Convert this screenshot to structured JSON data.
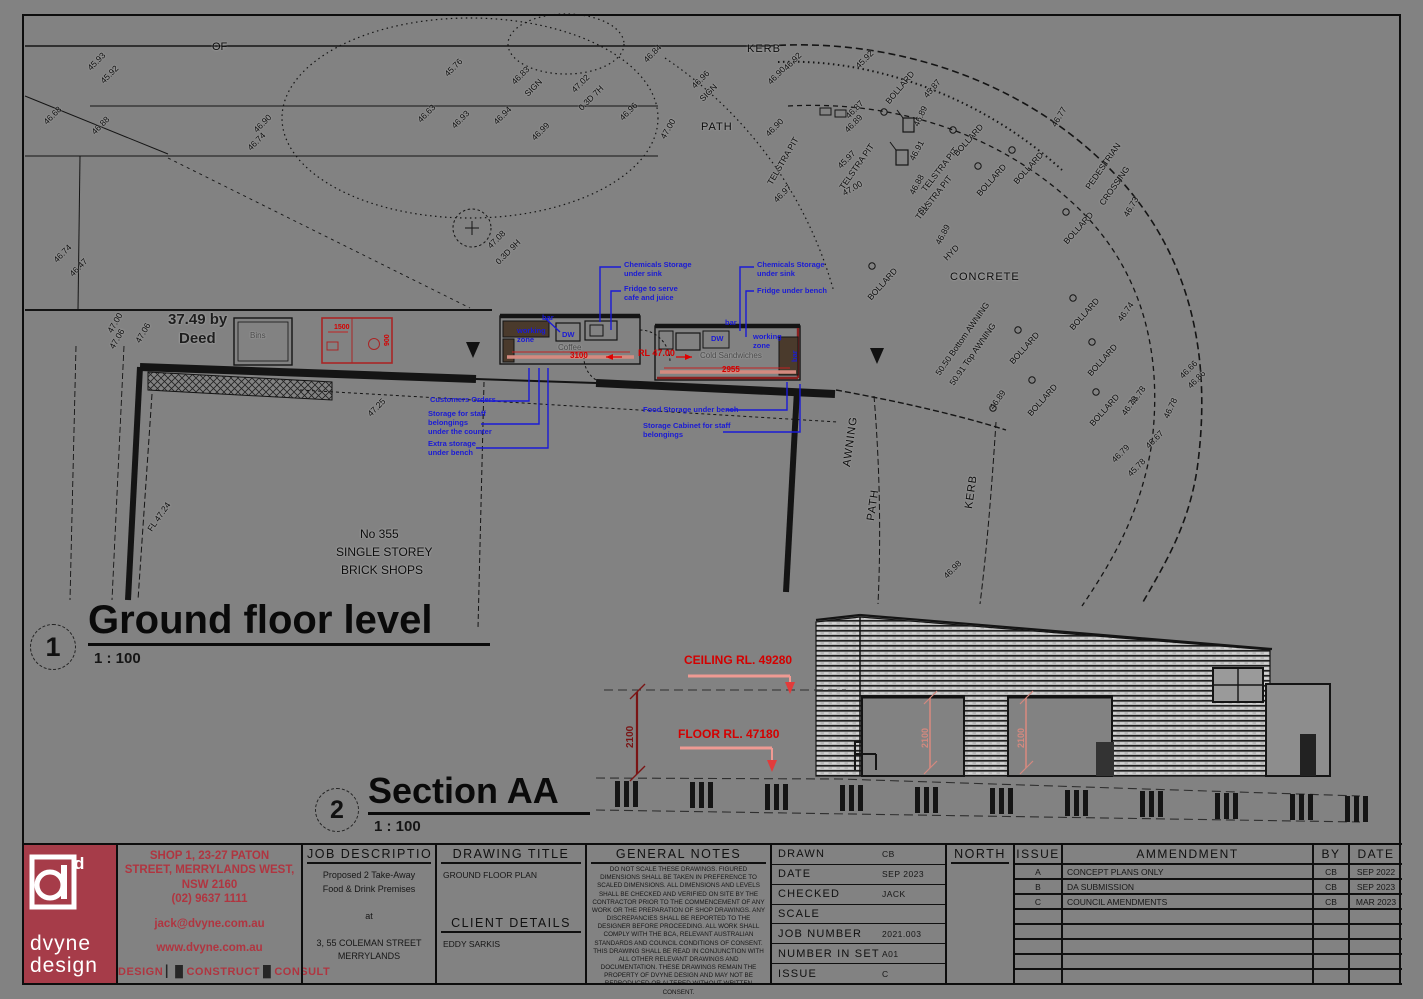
{
  "sheet": {
    "background": "#828282",
    "views": [
      {
        "number": "1",
        "title": "Ground floor level",
        "scale": "1 : 100"
      },
      {
        "number": "2",
        "title": "Section AA",
        "scale": "1 : 100"
      }
    ]
  },
  "drawing": {
    "labels": [
      {
        "t": "OF",
        "x": 212,
        "y": 42,
        "s": 11
      },
      {
        "t": "45.93",
        "x": 86,
        "y": 66,
        "r": -45
      },
      {
        "t": "45.92",
        "x": 99,
        "y": 79,
        "r": -45
      },
      {
        "t": "46.68",
        "x": 42,
        "y": 120,
        "r": -45
      },
      {
        "t": "46.88",
        "x": 90,
        "y": 130,
        "r": -45
      },
      {
        "t": "46.90",
        "x": 252,
        "y": 128,
        "r": -45
      },
      {
        "t": "46.74",
        "x": 246,
        "y": 146,
        "r": -45
      },
      {
        "t": "46.74",
        "x": 52,
        "y": 258,
        "r": -45
      },
      {
        "t": "46.47",
        "x": 68,
        "y": 272,
        "r": -45
      },
      {
        "t": "47.00",
        "x": 106,
        "y": 330,
        "r": -60
      },
      {
        "t": "46.63",
        "x": 416,
        "y": 118,
        "r": -45
      },
      {
        "t": "46.93",
        "x": 450,
        "y": 124,
        "r": -45
      },
      {
        "t": "46.94",
        "x": 492,
        "y": 120,
        "r": -45
      },
      {
        "t": "45.76",
        "x": 443,
        "y": 72,
        "r": -45
      },
      {
        "t": "46.83",
        "x": 510,
        "y": 80,
        "r": -45
      },
      {
        "t": "SIGN",
        "x": 523,
        "y": 92,
        "r": -45
      },
      {
        "t": "47.02",
        "x": 570,
        "y": 88,
        "r": -45
      },
      {
        "t": "0.3D 7H",
        "x": 577,
        "y": 106,
        "r": -45
      },
      {
        "t": "46.84",
        "x": 642,
        "y": 58,
        "r": -45
      },
      {
        "t": "46.96",
        "x": 618,
        "y": 116,
        "r": -45
      },
      {
        "t": "46.99",
        "x": 530,
        "y": 136,
        "r": -45
      },
      {
        "t": "47.00",
        "x": 659,
        "y": 136,
        "r": -60
      },
      {
        "t": "KERB",
        "x": 747,
        "y": 44,
        "c": "place"
      },
      {
        "t": "PATH",
        "x": 701,
        "y": 122,
        "c": "place"
      },
      {
        "t": "46.96",
        "x": 690,
        "y": 84,
        "r": -45
      },
      {
        "t": "SIGN",
        "x": 698,
        "y": 97,
        "r": -45
      },
      {
        "t": "46.92",
        "x": 782,
        "y": 66,
        "r": -45
      },
      {
        "t": "46.90",
        "x": 766,
        "y": 80,
        "r": -45
      },
      {
        "t": "45.92",
        "x": 854,
        "y": 64,
        "r": -45
      },
      {
        "t": "46.90",
        "x": 764,
        "y": 132,
        "r": -45
      },
      {
        "t": "TELSTRA PIT",
        "x": 766,
        "y": 182,
        "r": -60
      },
      {
        "t": "46.97",
        "x": 772,
        "y": 198,
        "r": -45
      },
      {
        "t": "BOLLARD",
        "x": 884,
        "y": 100,
        "r": -50
      },
      {
        "t": "45.87",
        "x": 922,
        "y": 94,
        "r": -50
      },
      {
        "t": "46.87",
        "x": 844,
        "y": 114,
        "r": -45
      },
      {
        "t": "46.89",
        "x": 843,
        "y": 128,
        "r": -45
      },
      {
        "t": "TELSTRA PIT",
        "x": 838,
        "y": 186,
        "r": -55
      },
      {
        "t": "46.89",
        "x": 912,
        "y": 124,
        "r": -65
      },
      {
        "t": "TELSTRA PIT",
        "x": 920,
        "y": 188,
        "r": -52
      },
      {
        "t": "46.91",
        "x": 908,
        "y": 158,
        "r": -62
      },
      {
        "t": "TELSTRA PIT",
        "x": 914,
        "y": 216,
        "r": -52
      },
      {
        "t": "BOLLARD",
        "x": 952,
        "y": 152,
        "r": -48
      },
      {
        "t": "BOLLARD",
        "x": 975,
        "y": 192,
        "r": -48
      },
      {
        "t": "BOLLARD",
        "x": 1012,
        "y": 180,
        "r": -48
      },
      {
        "t": "46.77",
        "x": 1050,
        "y": 124,
        "r": -60
      },
      {
        "t": "PEDESTRIAN",
        "x": 1084,
        "y": 186,
        "r": -55
      },
      {
        "t": "CROSSING",
        "x": 1098,
        "y": 202,
        "r": -55
      },
      {
        "t": "BOLLARD",
        "x": 1062,
        "y": 240,
        "r": -48
      },
      {
        "t": "46.73",
        "x": 1122,
        "y": 214,
        "r": -60
      },
      {
        "t": "46.88",
        "x": 908,
        "y": 192,
        "r": -62
      },
      {
        "t": "SV",
        "x": 916,
        "y": 210,
        "r": -45
      },
      {
        "t": "46.89",
        "x": 934,
        "y": 242,
        "r": -62
      },
      {
        "t": "HYD",
        "x": 942,
        "y": 256,
        "r": -45
      },
      {
        "t": "47.00",
        "x": 841,
        "y": 190,
        "r": -30
      },
      {
        "t": "45.97",
        "x": 836,
        "y": 164,
        "r": -45
      },
      {
        "t": "BOLLARD",
        "x": 866,
        "y": 296,
        "r": -48
      },
      {
        "t": "CONCRETE",
        "x": 950,
        "y": 272,
        "c": "place"
      },
      {
        "t": "50.50 Bottom AWNING",
        "x": 934,
        "y": 372,
        "r": -55
      },
      {
        "t": "50.91 Top AWNING",
        "x": 948,
        "y": 382,
        "r": -55
      },
      {
        "t": "BOLLARD",
        "x": 1008,
        "y": 360,
        "r": -48
      },
      {
        "t": "BOLLARD",
        "x": 1068,
        "y": 326,
        "r": -48
      },
      {
        "t": "BOLLARD",
        "x": 1026,
        "y": 412,
        "r": -48
      },
      {
        "t": "BOLLARD",
        "x": 1086,
        "y": 372,
        "r": -48
      },
      {
        "t": "46.74",
        "x": 1116,
        "y": 318,
        "r": -55
      },
      {
        "t": "BOLLARD",
        "x": 1088,
        "y": 422,
        "r": -48
      },
      {
        "t": "46.78",
        "x": 1128,
        "y": 402,
        "r": -55
      },
      {
        "t": "46.79",
        "x": 1120,
        "y": 412,
        "r": -55
      },
      {
        "t": "46.66",
        "x": 1178,
        "y": 374,
        "r": -45
      },
      {
        "t": "46.86",
        "x": 1186,
        "y": 384,
        "r": -45
      },
      {
        "t": "46.78",
        "x": 1162,
        "y": 416,
        "r": -65
      },
      {
        "t": "46.67",
        "x": 1144,
        "y": 444,
        "r": -45
      },
      {
        "t": "46.79",
        "x": 1110,
        "y": 458,
        "r": -45
      },
      {
        "t": "45.78",
        "x": 1126,
        "y": 472,
        "r": -45
      },
      {
        "t": "46.89",
        "x": 988,
        "y": 406,
        "r": -55
      },
      {
        "t": "KERB",
        "x": 964,
        "y": 508,
        "r": -82,
        "c": "place"
      },
      {
        "t": "AWNING",
        "x": 842,
        "y": 466,
        "r": -82,
        "c": "place"
      },
      {
        "t": "PATH",
        "x": 866,
        "y": 520,
        "r": -82,
        "c": "place"
      },
      {
        "t": "46.98",
        "x": 942,
        "y": 574,
        "r": -45
      },
      {
        "t": "47.06",
        "x": 108,
        "y": 346,
        "r": -60
      },
      {
        "t": "47.06",
        "x": 134,
        "y": 340,
        "r": -60
      },
      {
        "t": "37.49 by",
        "x": 168,
        "y": 312,
        "s": 15,
        "c": "deed"
      },
      {
        "t": "Deed",
        "x": 179,
        "y": 331,
        "s": 15,
        "c": "deed"
      },
      {
        "t": "FL 47.24",
        "x": 146,
        "y": 528,
        "r": -55
      },
      {
        "t": "47.25",
        "x": 366,
        "y": 412,
        "r": -45
      },
      {
        "t": "No 355",
        "x": 360,
        "y": 528,
        "s": 12
      },
      {
        "t": "SINGLE STOREY",
        "x": 336,
        "y": 546,
        "s": 12
      },
      {
        "t": "BRICK SHOPS",
        "x": 341,
        "y": 564,
        "s": 12
      },
      {
        "t": "47.08",
        "x": 486,
        "y": 244,
        "r": -45
      },
      {
        "t": "0.3D 9H",
        "x": 494,
        "y": 260,
        "r": -45
      },
      {
        "t": "Bins",
        "x": 250,
        "y": 332,
        "c": "gray"
      },
      {
        "t": "Coffee",
        "x": 558,
        "y": 344,
        "c": "gray"
      },
      {
        "t": "Cold Sandwiches",
        "x": 700,
        "y": 352,
        "c": "gray"
      },
      {
        "t": "Chemicals Storage\nunder sink",
        "x": 624,
        "y": 260,
        "c": "blue"
      },
      {
        "t": "Fridge to serve\ncafe and juice",
        "x": 624,
        "y": 284,
        "c": "blue"
      },
      {
        "t": "Chemicals Storage\nunder sink",
        "x": 757,
        "y": 260,
        "c": "blue"
      },
      {
        "t": "Fridge under bench",
        "x": 757,
        "y": 286,
        "c": "blue"
      },
      {
        "t": "working\nzone",
        "x": 517,
        "y": 326,
        "c": "blue"
      },
      {
        "t": "bar",
        "x": 542,
        "y": 313,
        "c": "blue"
      },
      {
        "t": "DW",
        "x": 562,
        "y": 330,
        "c": "blue"
      },
      {
        "t": "bar",
        "x": 725,
        "y": 318,
        "c": "blue"
      },
      {
        "t": "DW",
        "x": 711,
        "y": 334,
        "c": "blue"
      },
      {
        "t": "working\nzone",
        "x": 753,
        "y": 332,
        "c": "blue"
      },
      {
        "t": "bar",
        "x": 790,
        "y": 362,
        "r": -90,
        "c": "blue"
      },
      {
        "t": "Customers Orders",
        "x": 430,
        "y": 395,
        "c": "blue"
      },
      {
        "t": "Storage for staff\nbelongings\nunder the counter",
        "x": 428,
        "y": 409,
        "c": "blue"
      },
      {
        "t": "Extra storage\nunder bench",
        "x": 428,
        "y": 439,
        "c": "blue"
      },
      {
        "t": "Food Storage under bench",
        "x": 643,
        "y": 405,
        "c": "blue"
      },
      {
        "t": "Storage Cabinet for staff\nbelongings",
        "x": 643,
        "y": 421,
        "c": "blue"
      },
      {
        "t": "3100",
        "x": 570,
        "y": 352,
        "c": "red"
      },
      {
        "t": "RL 47.00",
        "x": 638,
        "y": 349,
        "c": "red",
        "s": 9
      },
      {
        "t": "2955",
        "x": 722,
        "y": 366,
        "c": "red"
      },
      {
        "t": "1500",
        "x": 334,
        "y": 324,
        "c": "red",
        "s": 7
      },
      {
        "t": "900",
        "x": 384,
        "y": 346,
        "r": -90,
        "c": "red",
        "s": 7
      },
      {
        "t": "CEILING RL. 49280",
        "x": 684,
        "y": 654,
        "c": "red",
        "s": 12
      },
      {
        "t": "FLOOR RL. 47180",
        "x": 678,
        "y": 728,
        "c": "red",
        "s": 12
      },
      {
        "t": "2100",
        "x": 626,
        "y": 748,
        "r": -90,
        "c": "darkred",
        "s": 10
      },
      {
        "t": "2100",
        "x": 921,
        "y": 748,
        "r": -90,
        "c": "pink",
        "s": 9
      },
      {
        "t": "2100",
        "x": 1017,
        "y": 748,
        "r": -90,
        "c": "pink",
        "s": 9
      }
    ]
  },
  "titleblock": {
    "logo": {
      "brand_top": "dvyne",
      "brand_bottom": "design",
      "accent": "#a63c49"
    },
    "contact": {
      "lines": [
        "SHOP 1, 23-27 PATON",
        "STREET, MERRYLANDS WEST,",
        "NSW 2160",
        "(02) 9637 1111",
        "jack@dvyne.com.au",
        "www.dvyne.com.au"
      ],
      "motto": [
        "DESIGN",
        "CONSTRUCT",
        "CONSULT"
      ],
      "text_color": "#b03540"
    },
    "job_description": {
      "header": "JOB DESCRIPTION",
      "body": "Proposed 2 Take-Away\nFood & Drink Premises\n\nat\n\n3, 55 COLEMAN STREET\nMERRYLANDS"
    },
    "drawing_title": {
      "header": "DRAWING TITLE",
      "value": "GROUND FLOOR PLAN"
    },
    "client": {
      "header": "CLIENT DETAILS",
      "value": "EDDY SARKIS"
    },
    "general_notes": {
      "header": "GENERAL NOTES",
      "text": "DO NOT SCALE THESE DRAWINGS. FIGURED DIMENSIONS SHALL BE TAKEN IN PREFERENCE TO SCALED DIMENSIONS. ALL DIMENSIONS AND LEVELS SHALL BE CHECKED AND VERIFIED ON SITE BY THE CONTRACTOR PRIOR TO THE COMMENCEMENT OF ANY WORK OR THE PREPARATION OF SHOP DRAWINGS. ANY DISCREPANCIES SHALL BE REPORTED TO THE DESIGNER BEFORE PROCEEDING. ALL WORK SHALL COMPLY WITH THE BCA, RELEVANT AUSTRALIAN STANDARDS AND COUNCIL CONDITIONS OF CONSENT. THIS DRAWING SHALL BE READ IN CONJUNCTION WITH ALL OTHER RELEVANT DRAWINGS AND DOCUMENTATION. THESE DRAWINGS REMAIN THE PROPERTY OF DVYNE DESIGN AND MAY NOT BE REPRODUCED OR ALTERED WITHOUT WRITTEN CONSENT."
    },
    "meta": {
      "rows": [
        {
          "label": "DRAWN",
          "value": "CB"
        },
        {
          "label": "DATE",
          "value": "SEP 2023"
        },
        {
          "label": "CHECKED",
          "value": "JACK"
        },
        {
          "label": "SCALE",
          "value": ""
        },
        {
          "label": "JOB NUMBER",
          "value": "2021.003"
        },
        {
          "label": "NUMBER IN SET",
          "value": "A01"
        },
        {
          "label": "ISSUE",
          "value": "C"
        }
      ]
    },
    "north": {
      "header": "NORTH"
    },
    "amendments": {
      "headers": [
        "ISSUE",
        "AMMENDMENT",
        "BY",
        "DATE"
      ],
      "rows": [
        [
          "A",
          "CONCEPT PLANS ONLY",
          "CB",
          "SEP 2022"
        ],
        [
          "B",
          "DA SUBMISSION",
          "CB",
          "SEP 2023"
        ],
        [
          "C",
          "COUNCIL AMENDMENTS",
          "CB",
          "MAR 2023"
        ]
      ],
      "empty_row_count": 5
    }
  }
}
